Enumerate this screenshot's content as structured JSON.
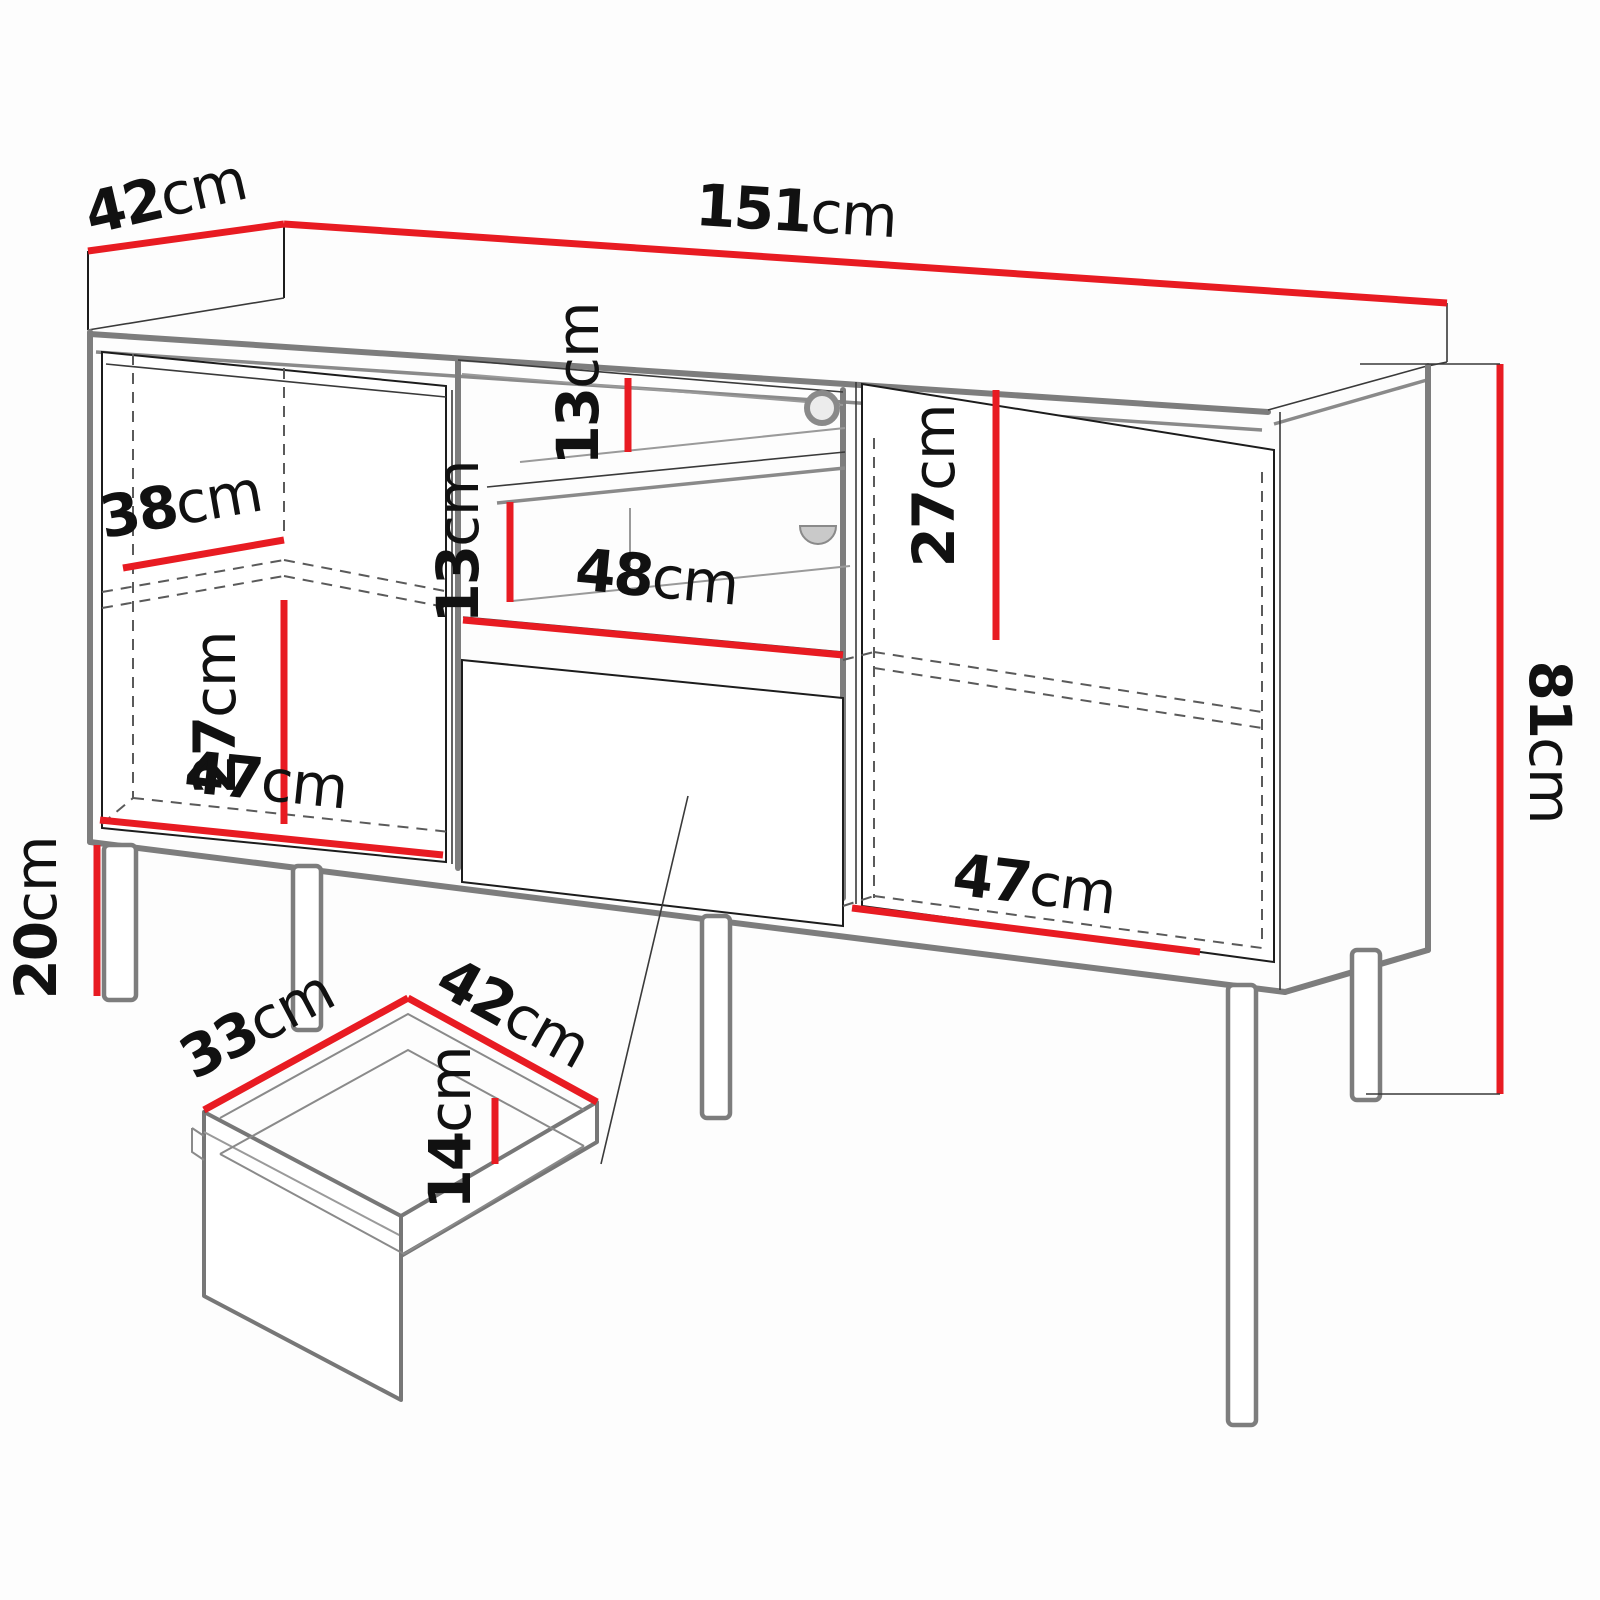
{
  "diagram": {
    "type": "furniture-dimension-diagram",
    "subject": "sideboard with two doors, open media niche with shelf, and drawer detail",
    "unit": "cm",
    "colors": {
      "dimension_line": "#e81b22",
      "structure_gray": "#7d7d7d",
      "outline_black": "#1c1c1c",
      "background": "#fdfdfd"
    },
    "dims": {
      "top_depth": {
        "value": "42",
        "unit": "cm"
      },
      "total_width": {
        "value": "151",
        "unit": "cm"
      },
      "total_height": {
        "value": "81",
        "unit": "cm"
      },
      "left_shelf_depth": {
        "value": "38",
        "unit": "cm"
      },
      "left_shelf_height": {
        "value": "27",
        "unit": "cm"
      },
      "left_compartment_width": {
        "value": "47",
        "unit": "cm"
      },
      "leg_height": {
        "value": "20",
        "unit": "cm"
      },
      "niche_upper_gap": {
        "value": "13",
        "unit": "cm"
      },
      "niche_lower_gap": {
        "value": "13",
        "unit": "cm"
      },
      "niche_width": {
        "value": "48",
        "unit": "cm"
      },
      "right_shelf_height": {
        "value": "27",
        "unit": "cm"
      },
      "right_compartment_width": {
        "value": "47",
        "unit": "cm"
      },
      "drawer_depth": {
        "value": "33",
        "unit": "cm"
      },
      "drawer_width": {
        "value": "42",
        "unit": "cm"
      },
      "drawer_height": {
        "value": "14",
        "unit": "cm"
      }
    }
  }
}
